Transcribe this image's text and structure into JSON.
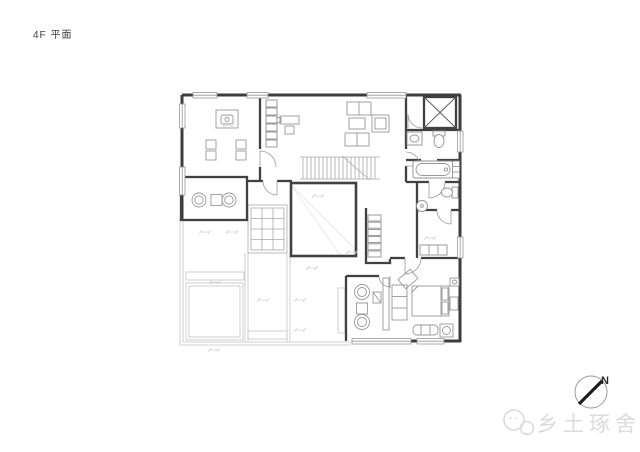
{
  "page": {
    "title_label": "4F 平面",
    "background_color": "#ffffff"
  },
  "compass": {
    "north_label": "N",
    "arrow_points": "northeast"
  },
  "watermark": {
    "brand": "乡土琢舍",
    "logo": "chat-faces-logo",
    "color": "#dbdbdb"
  },
  "drawing": {
    "type": "architectural-floor-plan",
    "floor": "4F",
    "colors": {
      "wall": "#3d3d3d",
      "furniture_line": "#989898",
      "terrace_line": "#c4c4c4",
      "stair_line": "#a8a8a8"
    }
  }
}
